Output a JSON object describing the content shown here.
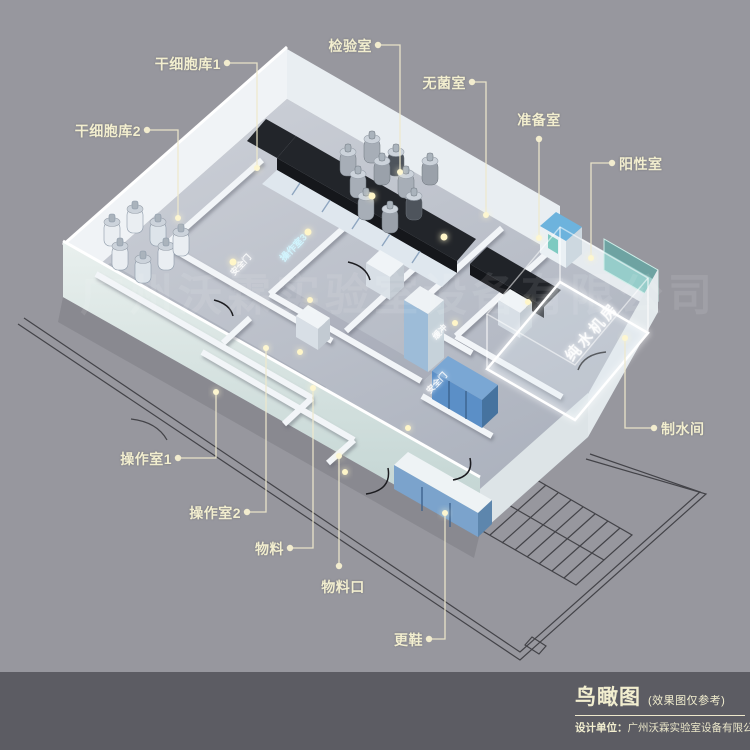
{
  "canvas": {
    "width": 750,
    "height": 750
  },
  "colors": {
    "background": "#97979e",
    "footer_background": "#5c5c63",
    "label_text": "#f2eecf",
    "leader_line": "#efe9cc",
    "cad_line": "#35353a",
    "wall_white": "#f2f5f8",
    "floor_gray": "#bdc1ca",
    "front_wall_mint": "#d7e4e2",
    "bench_dark": "#22252a",
    "cabinet_blue": "#7aa7d4",
    "glass_teal": "#46afa5",
    "biosafety_blue_top": "#6db3dd",
    "glow_room_edge": "#ffffff",
    "lamp_glow": "#fff6c8"
  },
  "callouts": [
    {
      "id": "stem-cell-bank-1",
      "text": "干细胞库1"
    },
    {
      "id": "stem-cell-bank-2",
      "text": "干细胞库2"
    },
    {
      "id": "inspection-room",
      "text": "检验室"
    },
    {
      "id": "sterile-room",
      "text": "无菌室"
    },
    {
      "id": "preparation-room",
      "text": "准备室"
    },
    {
      "id": "positive-room",
      "text": "阳性室"
    },
    {
      "id": "water-making-room",
      "text": "制水间"
    },
    {
      "id": "operation-room-1",
      "text": "操作室1"
    },
    {
      "id": "operation-room-2",
      "text": "操作室2"
    },
    {
      "id": "materials",
      "text": "物料"
    },
    {
      "id": "materials-port",
      "text": "物料口"
    },
    {
      "id": "shoe-change",
      "text": "更鞋"
    }
  ],
  "interior_labels": {
    "operation_room_3": "操作室3",
    "safety_door_1": "安全门",
    "buffer": "缓冲",
    "safety_door_2": "安全门",
    "pure_water_room": "纯水机房"
  },
  "watermark": "广州沃霖实验室设备有限公司",
  "title_block": {
    "title": "鸟瞰图",
    "subtitle": "(效果图仅参考)",
    "designer_label": "设计单位：",
    "designer_name": "广州沃霖实验室设备有限公司"
  }
}
